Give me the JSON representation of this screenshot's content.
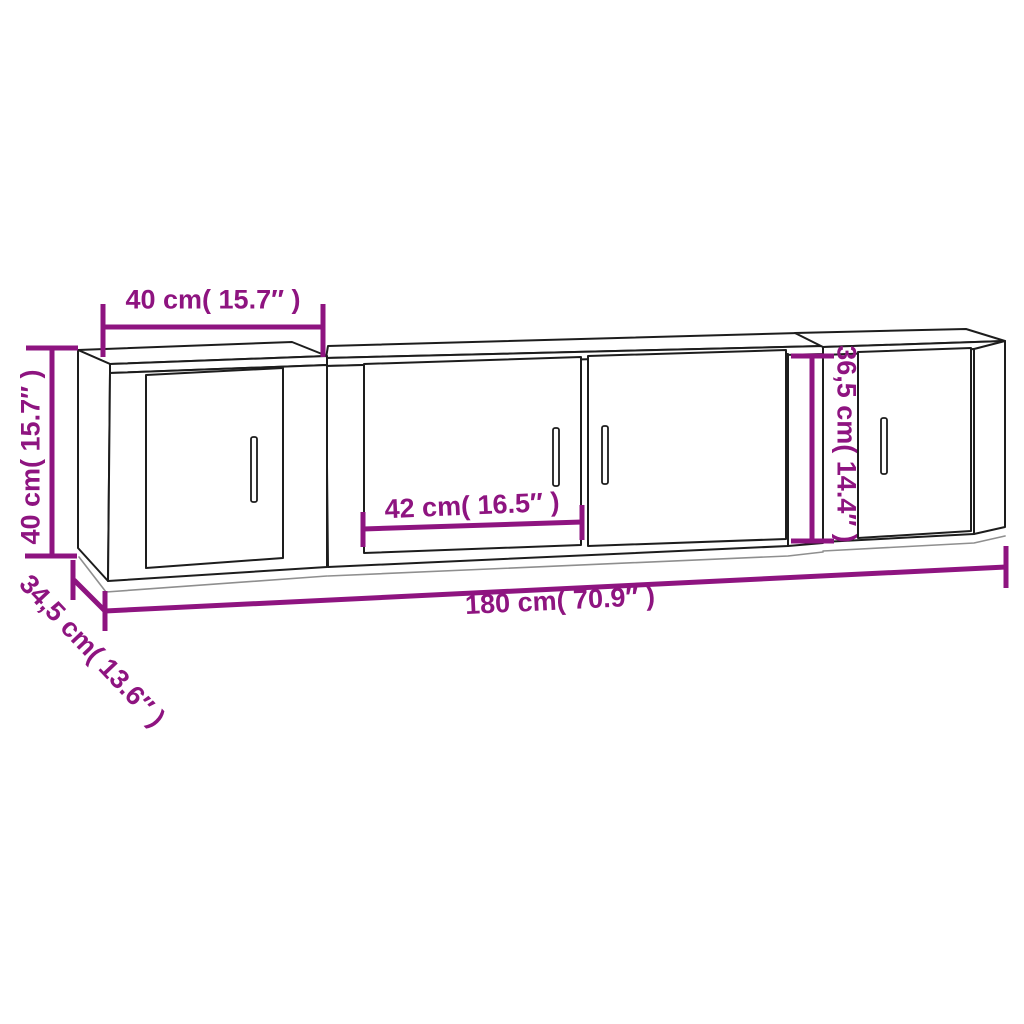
{
  "page": {
    "background": "#ffffff"
  },
  "drawing": {
    "accent_color": "#8E1480",
    "line_color": "#1d1d1d",
    "light_line_color": "#8f8f8f"
  },
  "labels": {
    "top_width": "40 cm( 15.7″ )",
    "left_height": "40 cm( 15.7″ )",
    "door_width": "42 cm( 16.5″ )",
    "right_height": "36,5 cm( 14.4″ )",
    "total_width": "180 cm( 70.9″ )",
    "depth": "34,5 cm( 13.6″ )"
  }
}
